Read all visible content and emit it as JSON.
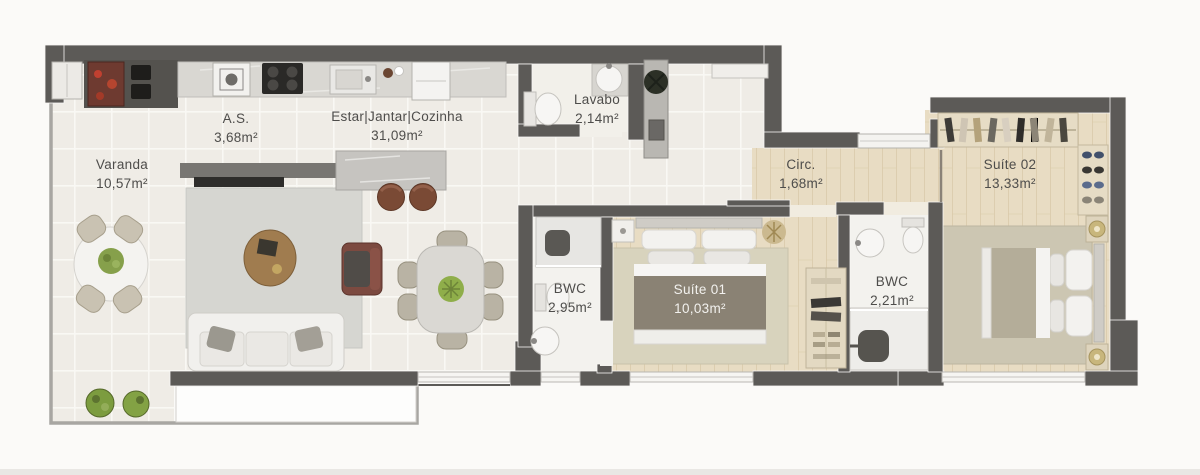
{
  "plan_title": "Floor plan – apartment",
  "rooms": [
    {
      "id": "varanda",
      "name": "Varanda",
      "area": "10,57m²"
    },
    {
      "id": "area-de-servico",
      "name": "A.S.",
      "area": "3,68m²"
    },
    {
      "id": "estar-jantar-cozinha",
      "name": "Estar|Jantar|Cozinha",
      "area": "31,09m²"
    },
    {
      "id": "lavabo",
      "name": "Lavabo",
      "area": "2,14m²"
    },
    {
      "id": "circulacao",
      "name": "Circ.",
      "area": "1,68m²"
    },
    {
      "id": "bwc-suite-01",
      "name": "BWC",
      "area": "2,95m²"
    },
    {
      "id": "suite-01",
      "name": "Suíte 01",
      "area": "10,03m²"
    },
    {
      "id": "bwc-suite-02",
      "name": "BWC",
      "area": "2,21m²"
    },
    {
      "id": "suite-02",
      "name": "Suíte 02",
      "area": "13,33m²"
    }
  ],
  "colors": {
    "wall": "#5c5a57",
    "tile_floor": "#efece6",
    "wood_floor": "#e8dcc3",
    "label_text": "#4e4d4b",
    "label_text_light": "#f2f1ee",
    "accent_grill": "#8c3b2e",
    "accent_plant": "#7c9c3f"
  }
}
